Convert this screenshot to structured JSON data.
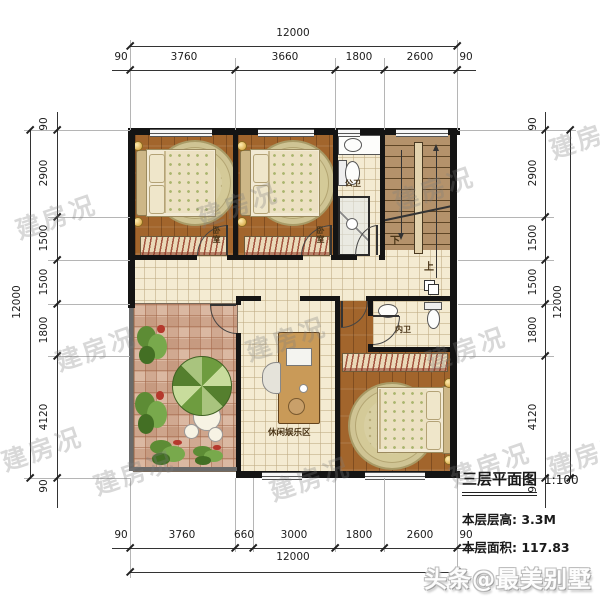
{
  "title_block": {
    "title": "三层平面图",
    "scale": "1:100",
    "floor_height_label": "本层层高:",
    "floor_height_value": "3.3M",
    "floor_area_label": "本层面积:",
    "floor_area_value": "117.83"
  },
  "watermark": {
    "text": "建房况",
    "credit": "头条@最美别墅"
  },
  "rooms": {
    "bedroom1_label": "卧室",
    "bedroom2_label": "卧室",
    "public_bath_label": "公卫",
    "private_bath_label": "内卫",
    "leisure_label": "休闲娱乐区",
    "stair_up_label": "上",
    "stair_down_label": "下"
  },
  "dimensions": {
    "top": {
      "total": "12000",
      "segments": [
        "90",
        "3760",
        "3660",
        "1800",
        "2600",
        "90"
      ]
    },
    "bottom": {
      "total": "12000",
      "segments": [
        "90",
        "3760",
        "660",
        "3000",
        "1800",
        "2600",
        "90"
      ]
    },
    "left": {
      "total": "12000",
      "segments": [
        "90",
        "2900",
        "1500",
        "1500",
        "1800",
        "4120",
        "90"
      ]
    },
    "right": {
      "total": "12000",
      "segments": [
        "90",
        "2900",
        "1500",
        "1500",
        "1800",
        "4120",
        "90"
      ]
    }
  },
  "palette": {
    "wall": "#141414",
    "wood_floor": "#a2652c",
    "tile_floor": "#f4ebd2",
    "terrace_tile": "#ecd3bf",
    "umbrella_green": "#6e9c3f",
    "rug": "#d8cfa2"
  }
}
